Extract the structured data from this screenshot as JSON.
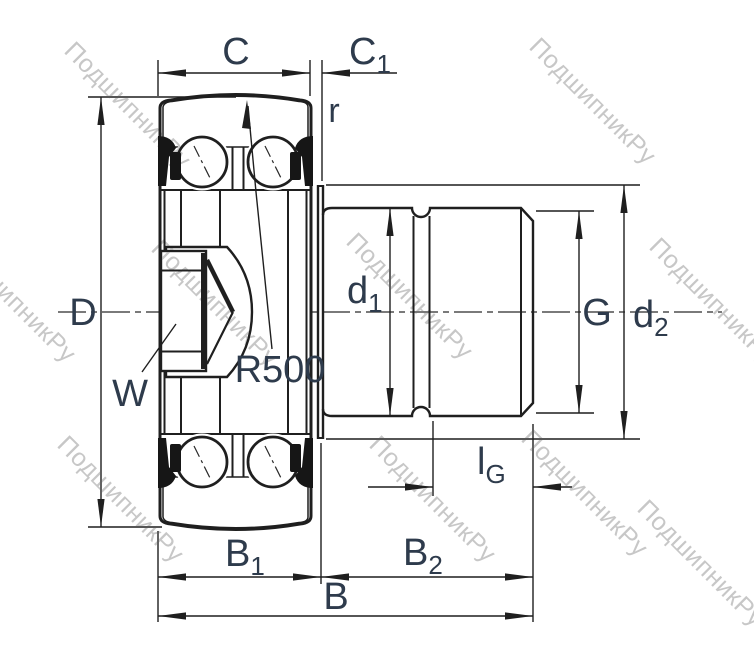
{
  "diagram": {
    "type": "bearing-cross-section-technical-drawing",
    "watermark": {
      "text": "ПодшипникРу"
    },
    "colors": {
      "line": "#1f1f1f",
      "label": "#2e3b4c",
      "watermark": "#c7c7c7",
      "background": "#ffffff"
    },
    "labels": {
      "C": {
        "main": "C"
      },
      "C1": {
        "main": "C",
        "sub": "1"
      },
      "r": {
        "main": "r"
      },
      "D": {
        "main": "D"
      },
      "W": {
        "main": "W"
      },
      "R500": {
        "main": "R500"
      },
      "d1": {
        "main": "d",
        "sub": "1"
      },
      "G": {
        "main": "G"
      },
      "d2": {
        "main": "d",
        "sub": "2"
      },
      "lG": {
        "main": "l",
        "sub": "G"
      },
      "B1": {
        "main": "B",
        "sub": "1"
      },
      "B2": {
        "main": "B",
        "sub": "2"
      },
      "B": {
        "main": "B"
      }
    }
  }
}
